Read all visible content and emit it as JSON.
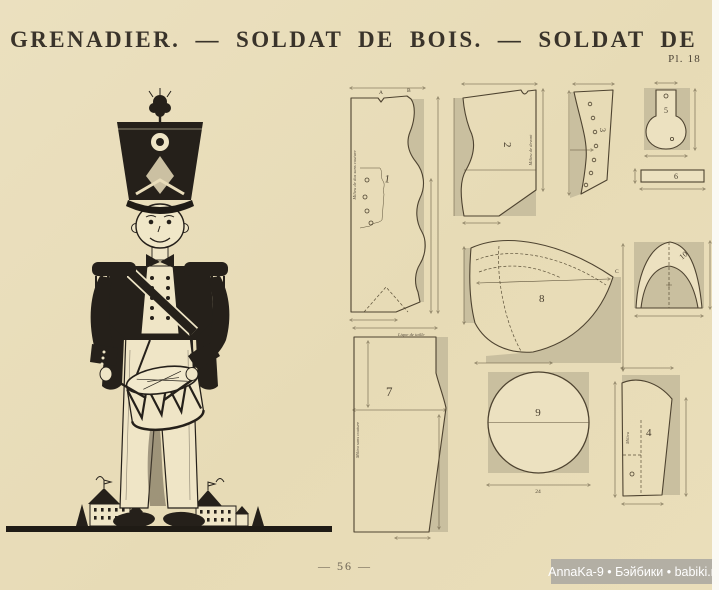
{
  "page": {
    "title": "GRENADIER.  —  SOLDAT DE BOIS.  —  SOLDAT DE PLOMB",
    "plate_label": "Pl. 18",
    "page_number": "— 56 —",
    "watermark": "AnnaKa-9 • Бэйбики • babiki.ru"
  },
  "patterns": {
    "pieces": [
      {
        "number": "1",
        "label": "Milieu de dos sans couture",
        "marker_a": "A",
        "marker_b": "B"
      },
      {
        "number": "2",
        "label": "Milieu de devant"
      },
      {
        "number": "3"
      },
      {
        "number": "4",
        "label": "Milieu"
      },
      {
        "number": "5"
      },
      {
        "number": "6"
      },
      {
        "number": "7",
        "label": "Milieu sans couture",
        "waistline_label": "Ligne de taille"
      },
      {
        "number": "8",
        "marker_c": "C"
      },
      {
        "number": "9",
        "width_label": "24"
      },
      {
        "number": "10"
      }
    ]
  },
  "colors": {
    "paper": "#e8dcba",
    "pattern_shade": "#c9bf9f",
    "ink": "#4e4330",
    "figure_ink": "#25201a",
    "watermark_bg": "#aeaba3"
  }
}
